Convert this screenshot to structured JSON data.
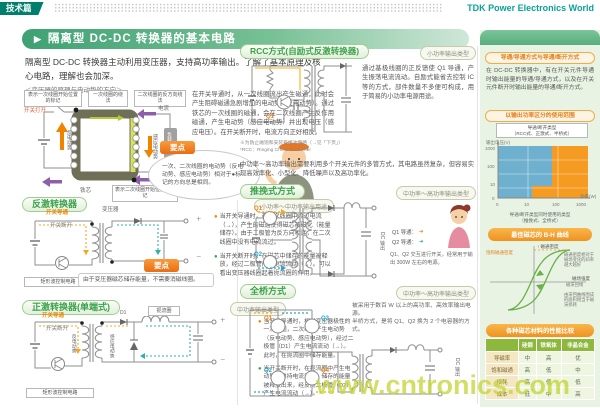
{
  "icons": {
    "title_arrow": "▶",
    "bullet": "●",
    "arrow_right": "➜",
    "plus": "＋",
    "minus": "－"
  },
  "page": {
    "corner_tag": "技术篇",
    "brand": "TDK Power Electronics World",
    "title": "隔离型 DC-DC 转换器的基本电路",
    "intro": "隔离型 DC-DC 转换器主动利用变压器，支持高功率输出。了解了基本原理及核心电路，理解也会加深。",
    "watermark": "www.cntronics.com"
  },
  "principle": {
    "caption": "＜变压器的原理与电动势的方向＞",
    "body": "在开关导通时，从一次线圈流出产生磁通，此时会产生阻碍磁通急剧增加的电动势（反电动势）。通过铁芯的一次线圈的磁通，会在二次线圈产生反作用磁通，产生电动势（感应电动势）并出现电压（感应电压）。在开关断开时，电流方向正好相反。",
    "point_label": "要点",
    "point_text": "一次、二次线圈的电动势（反电动势、感应电动势）相对于●标记的方向总是相同。",
    "labels": {
      "primary_mark": "表示一次线圈开始位置的标记",
      "primary_winding": "一次线圈的绕法",
      "secondary_winding": "二次线圈的反方向绕法",
      "switch_open": "开关打开",
      "back_emf": "反电动势",
      "current": "电流",
      "induced_emf": "感应电动势",
      "load": "负载",
      "core": "铁芯",
      "secondary_mark": "表示二次线圈开始位置的标记"
    }
  },
  "flyback": {
    "title": "反激转换器",
    "badge": "小功率～中功率输出用途",
    "labels": {
      "switch_on": "开关导通",
      "switch_off": "开关断开",
      "transformer": "变压器",
      "control": "矩形波控制电路"
    },
    "point_label": "要点",
    "point_text": "由于变压器磁芯储存能量，不需要消磁线圈。",
    "bullets": [
      {
        "text": "当开关导通时，在一次线圈中流过电流（→），产生的磁通使得磁芯被磁化（能量储存）。由于二极管为反方向相连，在二次线圈中没有电流流过。"
      },
      {
        "text": "当开关断开时，在磁芯中储存的能量被释放，经过二极管产生电流流动（→）。可以看出变压器线圈起着扼流圈的作用。"
      }
    ]
  },
  "forward": {
    "title": "正激转换器(单端式)",
    "badge": "中功率输出类型",
    "labels": {
      "switch_on": "开关导通",
      "switch_off": "开关断开",
      "back_emf": "反电动势",
      "induced_emf": "感应电动势",
      "choke": "扼流圈",
      "d1": "D1",
      "control": "矩形波控制电路"
    },
    "bullets": [
      {
        "text": "当开关导通时，相对变压器极性的一次线圈，二次线圈产生电动势（反电动势、感应电动势），经过二极管（D1）产生电流流动（→）。此时，在扼流圈中储存能量。"
      },
      {
        "text": "当开关断开时，在扼流圈中产生电动势以维持电流流动，储存的能量被释放出来，经反向二极管（D2）产生电流流动（→）。"
      }
    ]
  },
  "rcc": {
    "title": "RCC方式(自励式反激转换器)",
    "badge": "小功率输出类型",
    "q1": "Q1",
    "body": "通过基极线圈的正反馈使 Q1 导通，产生振荡电流流动。自励式能省去控制 IC 等的方式，部件数量不多便可构成，用于简易的小功率电源用途。",
    "note1": "※为防止磁饱和安装有缓冲电路（→见「下页」）",
    "note2": "*RCC：Ringing Choke Converter"
  },
  "mid_text": "中功率～高功率输出需要利用多个开关元件的多管方式，其电路虽然复杂，但容易实现高效率化、小型化、降低噪声以及高功率化。",
  "pushpull": {
    "title": "推挽式方式",
    "badge": "中功率～高功率输出类型",
    "q1": "Q1",
    "q2": "Q2",
    "dc_out": "DC 输出",
    "legend_q1": "Q1 导通：",
    "legend_q2": "Q2 导通：",
    "body": "Q1、Q2 交互进行开关，经常用于输出 300W 左右的电源。"
  },
  "fullbridge": {
    "title": "全桥方式",
    "badge": "中功率～高功率输出类型",
    "q1": "Q1",
    "q2": "Q2",
    "q3": "Q3",
    "q4": "Q4",
    "dc_out": "DC 输出",
    "body1": "被采用于数百 W 以上的高功率、高效率输出电源。",
    "body2": "半桥方式，是将 Q1、Q2 换为 2 个电容器的方式。"
  },
  "sidebar": {
    "pill1": "导通/导通方式与导通/断开方式",
    "text1": "在 DC-DC 转换器中，有在开关元件导通时输出能量的导通/导通方式，以及在开关元件断开时输出能量的导通/断开方式。",
    "pill2": "以输出功率区分的使用范围",
    "chart": {
      "callout_line1": "导通/断开类型",
      "callout_line2": "（RCC式、正激式、半桥式）",
      "ylabel": "输出电压(V)",
      "xlabel": "功率(W)",
      "yticks": [
        "1000",
        "100",
        "10",
        "0"
      ],
      "xticks": [
        "0",
        "10",
        "100",
        "1000"
      ],
      "caption_line1": "导通/断开类型同时使用的类型",
      "caption_line2": "（推挽式、全桥式）"
    },
    "pill3": "最佳磁芯的 B-H 曲线",
    "bh": {
      "top_label": "↑ 磁通密度",
      "x_label": "磁场强度",
      "left_label": "饱和磁通密度",
      "ann1": "磁通密度相对于磁场变化的斜率越大越好",
      "ann2": "磁滞回线",
      "ann3": "由滞回曲线围成的面积相当于磁滞损耗"
    },
    "table_title": "各种磁芯材料的性能比较",
    "table": {
      "columns": [
        "",
        "硅钢",
        "铁氧体",
        "非晶合金"
      ],
      "rows": [
        {
          "label": "导磁率",
          "values": [
            "中",
            "高",
            "优"
          ]
        },
        {
          "label": "饱和磁通",
          "values": [
            "高",
            "低",
            "中"
          ]
        },
        {
          "label": "损耗",
          "values": [
            "高",
            "低",
            "低"
          ]
        },
        {
          "label": "成本",
          "values": [
            "低",
            "中",
            "高"
          ]
        }
      ]
    }
  }
}
